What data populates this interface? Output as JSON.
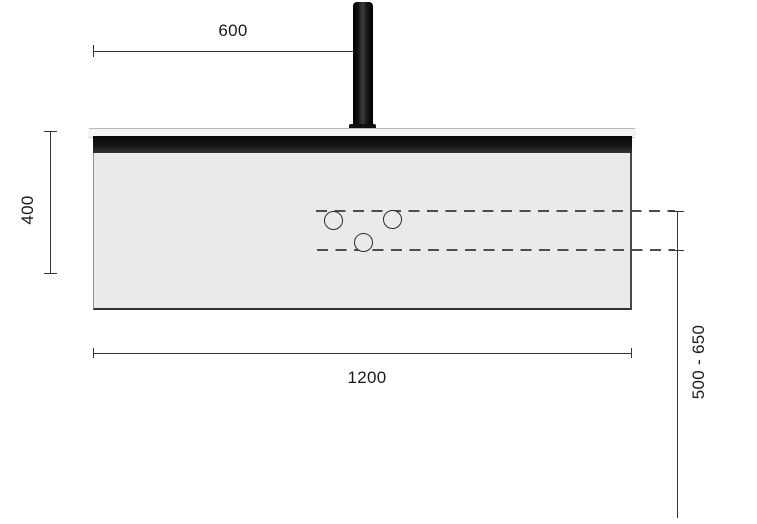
{
  "diagram": {
    "type": "technical-dimension-drawing",
    "subject": "wall-mounted washbasin countertop with faucet pipe, front elevation",
    "dimensions": {
      "faucet_offset": {
        "label": "600"
      },
      "panel_height": {
        "label": "400"
      },
      "panel_width": {
        "label": "1200"
      },
      "installation_height_range": {
        "label": "500 - 650"
      }
    },
    "outlet_holes_count": 3,
    "colors": {
      "background": "#ffffff",
      "panel_fill": "#eaeaea",
      "front_band": "#111111",
      "counter_top": "#f4f4f4",
      "dimension_line": "#333333",
      "dashed_guide": "#4d4d4d"
    }
  }
}
